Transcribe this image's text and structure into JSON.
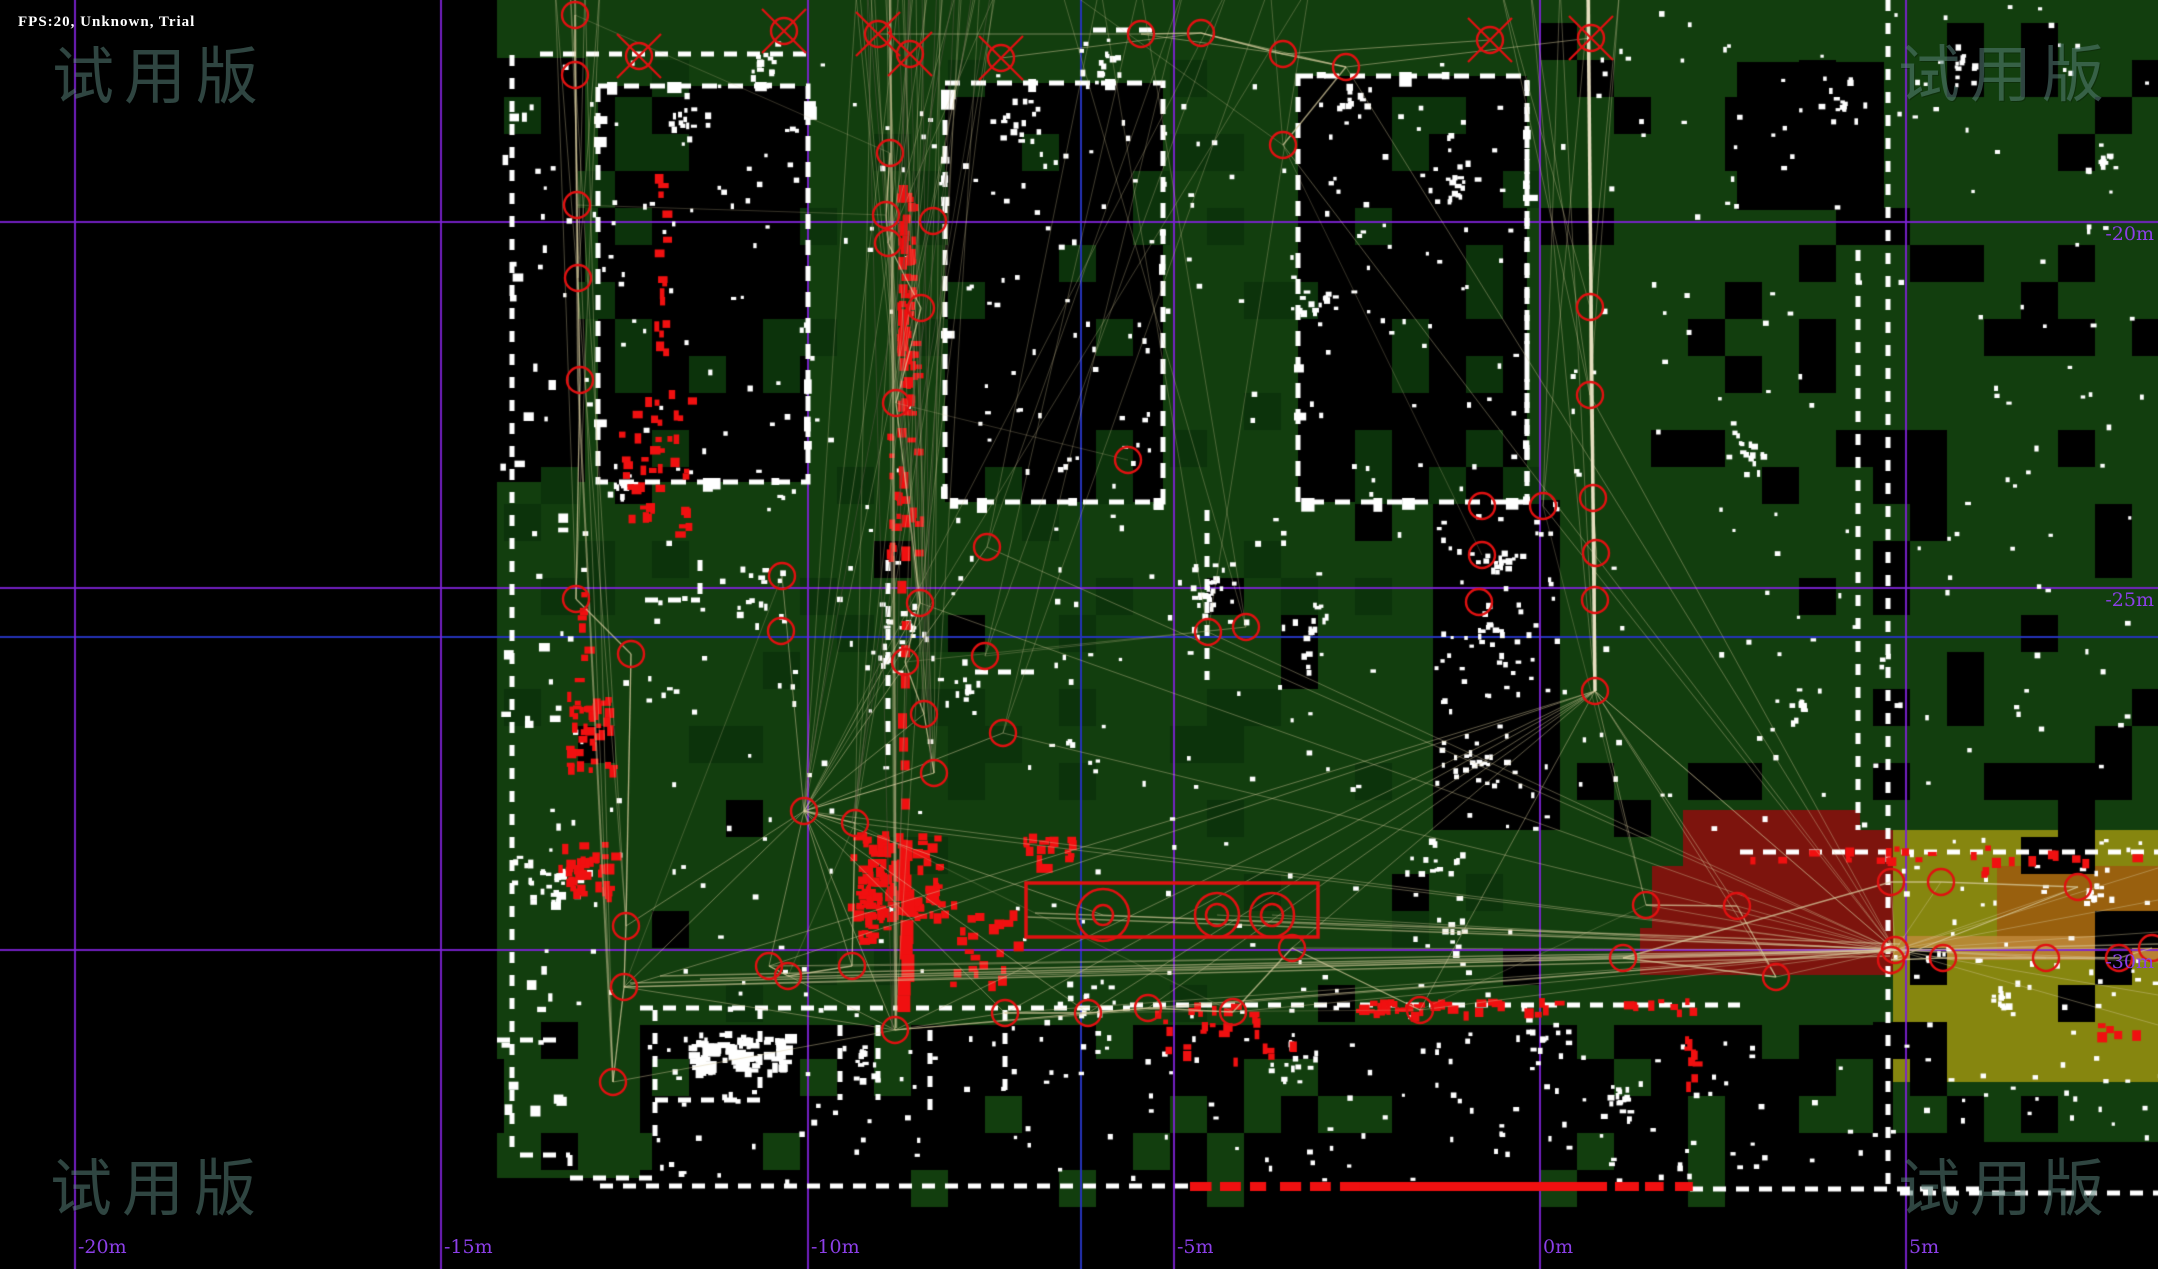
{
  "hud": {
    "status_text": "FPS:20, Unknown, Trial"
  },
  "watermark": {
    "text": "试用版",
    "positions": [
      {
        "x": 52,
        "y": 26
      },
      {
        "x": 1898,
        "y": 24
      },
      {
        "x": 50,
        "y": 1138
      },
      {
        "x": 1898,
        "y": 1138
      }
    ]
  },
  "grid": {
    "purple_color": "#7D22D4",
    "blue_color": "#2433B8",
    "label_color": "#8C3FE8",
    "purple_x": [
      74,
      440,
      807,
      1173,
      1539,
      1905
    ],
    "purple_y": [
      221,
      587,
      949
    ],
    "blue_x": [
      1080
    ],
    "blue_y": [
      636
    ],
    "x_labels": [
      {
        "text": "-20m",
        "x": 74
      },
      {
        "text": "-15m",
        "x": 440
      },
      {
        "text": "-10m",
        "x": 807
      },
      {
        "text": "-5m",
        "x": 1173
      },
      {
        "text": "0m",
        "x": 1539
      },
      {
        "text": "5m",
        "x": 1905
      }
    ],
    "y_labels": [
      {
        "text": "-20m",
        "y": 221
      },
      {
        "text": "-25m",
        "y": 587
      },
      {
        "text": "-30m",
        "y": 949
      }
    ]
  },
  "map": {
    "seed": 20,
    "colors": {
      "free": "#123E0E",
      "free_dark": "#0C330B",
      "free_light": "#1A5412",
      "unknown": "#000000",
      "wall": "#FFFFFF",
      "scan": "#F01010",
      "node": "#E01111",
      "edge": "218,205,160",
      "edge_dark": "95,92,72",
      "maroon": "#7D140D",
      "olive": "#86860F",
      "brown": "#99600E",
      "band": "#C08A3C"
    },
    "green_rects": [
      [
        497,
        0,
        1396,
        1025
      ],
      [
        497,
        1025,
        160,
        153
      ],
      [
        1893,
        0,
        265,
        830
      ],
      [
        1893,
        1082,
        265,
        60
      ]
    ],
    "black_rects": [
      [
        497,
        58,
        88,
        424
      ],
      [
        640,
        1025,
        1253,
        157
      ],
      [
        1433,
        500,
        127,
        330
      ],
      [
        1737,
        62,
        147,
        148
      ]
    ],
    "rooms": [
      [
        598,
        86,
        210,
        396
      ],
      [
        945,
        83,
        218,
        419
      ],
      [
        1298,
        76,
        229,
        426
      ]
    ],
    "maroon_poly": [
      [
        1683,
        810
      ],
      [
        1860,
        810
      ],
      [
        1860,
        830
      ],
      [
        1893,
        830
      ],
      [
        1893,
        975
      ],
      [
        1640,
        975
      ],
      [
        1640,
        928
      ],
      [
        1652,
        928
      ],
      [
        1652,
        866
      ],
      [
        1683,
        866
      ]
    ],
    "olive_rect": [
      1893,
      830,
      265,
      252
    ],
    "brown_rect": [
      1997,
      866,
      161,
      92
    ],
    "band_rect": [
      1893,
      936,
      265,
      24
    ],
    "checker_zones": [
      {
        "x": 1893,
        "x2": 2158,
        "y": 0,
        "y2": 830,
        "p": 0.22,
        "c": "unknown"
      },
      {
        "x": 1560,
        "x2": 1888,
        "y": 0,
        "y2": 830,
        "p": 0.11,
        "c": "unknown"
      },
      {
        "x": 520,
        "x2": 1530,
        "y": 490,
        "y2": 1020,
        "p": 0.035,
        "c": "unknown"
      },
      {
        "x": 520,
        "x2": 1530,
        "y": 490,
        "y2": 1020,
        "p": 0.1,
        "c": "free_dark"
      },
      {
        "x": 520,
        "x2": 1530,
        "y": 60,
        "y2": 490,
        "p": 0.05,
        "c": "free_dark"
      },
      {
        "x": 640,
        "x2": 1893,
        "y": 1025,
        "y2": 1180,
        "p": 0.13,
        "c": "free"
      },
      {
        "x": 1893,
        "x2": 2158,
        "y": 830,
        "y2": 1082,
        "p": 0.1,
        "c": "unknown"
      },
      {
        "x": 1893,
        "x2": 2158,
        "y": 1082,
        "y2": 1142,
        "p": 0.25,
        "c": "unknown"
      },
      {
        "x": 497,
        "x2": 657,
        "y": 1025,
        "y2": 1178,
        "p": 0.15,
        "c": "unknown"
      },
      {
        "x": 598,
        "x2": 1527,
        "y": 86,
        "y2": 500,
        "p": 0.08,
        "c": "free_dark"
      }
    ],
    "walls": {
      "h_dashed": [
        [
          540,
          810,
          54
        ],
        [
          1093,
          1160,
          30
        ],
        [
          640,
          1130,
          1008
        ],
        [
          655,
          760,
          1100
        ],
        [
          1130,
          1740,
          1005
        ],
        [
          1740,
          2158,
          852
        ],
        [
          600,
          1190,
          1186
        ],
        [
          1690,
          1988,
          1189
        ],
        [
          1900,
          2158,
          1193
        ],
        [
          645,
          700,
          600
        ],
        [
          975,
          1035,
          672
        ],
        [
          520,
          570,
          1155
        ],
        [
          570,
          660,
          1178
        ],
        [
          497,
          560,
          1040
        ]
      ],
      "v_dashed": [
        [
          512,
          55,
          1150
        ],
        [
          655,
          1010,
          1140
        ],
        [
          760,
          1008,
          1100
        ],
        [
          930,
          1030,
          1120
        ],
        [
          1005,
          1010,
          1100
        ],
        [
          700,
          560,
          600
        ],
        [
          888,
          560,
          760
        ],
        [
          1207,
          510,
          680
        ],
        [
          1527,
          80,
          500
        ],
        [
          1888,
          0,
          1190
        ],
        [
          1858,
          250,
          830
        ],
        [
          570,
          1155,
          1178
        ],
        [
          840,
          1025,
          1100
        ],
        [
          878,
          1025,
          1100
        ]
      ],
      "red_wall_solid": [
        1350,
        1182,
        235,
        9
      ],
      "red_wall_dash_ranges": [
        [
          1190,
          1350
        ],
        [
          1585,
          1690
        ]
      ],
      "red_wall_y": 1182
    },
    "red_clusters": [
      [
        897,
        185,
        16,
        235,
        0.9
      ],
      [
        885,
        430,
        40,
        130,
        0.25
      ],
      [
        846,
        830,
        96,
        85,
        0.75
      ],
      [
        852,
        874,
        32,
        66,
        0.6
      ],
      [
        1022,
        832,
        50,
        33,
        0.6
      ],
      [
        566,
        690,
        44,
        80,
        0.6
      ],
      [
        558,
        840,
        54,
        60,
        0.65
      ],
      [
        574,
        590,
        12,
        100,
        0.3
      ],
      [
        618,
        388,
        70,
        144,
        0.22
      ],
      [
        652,
        170,
        12,
        190,
        0.35
      ],
      [
        950,
        900,
        70,
        85,
        0.2
      ],
      [
        1352,
        998,
        210,
        14,
        0.7
      ],
      [
        1150,
        1002,
        110,
        30,
        0.3
      ],
      [
        1620,
        998,
        80,
        12,
        0.5
      ],
      [
        1682,
        1035,
        12,
        48,
        0.8
      ],
      [
        2085,
        1015,
        50,
        28,
        0.18
      ],
      [
        1977,
        862,
        20,
        10,
        0.5
      ],
      [
        1160,
        1040,
        140,
        20,
        0.15
      ],
      [
        1740,
        845,
        420,
        14,
        0.22
      ]
    ],
    "red_strip": {
      "x": 897,
      "y1": 185,
      "y2": 1010
    },
    "nodes": {
      "left_chain": [
        [
          575,
          15
        ],
        [
          575,
          75
        ],
        [
          577,
          205
        ],
        [
          578,
          278
        ],
        [
          580,
          380
        ],
        [
          576,
          599
        ],
        [
          631,
          654
        ],
        [
          626,
          926
        ],
        [
          624,
          987
        ],
        [
          613,
          1082
        ]
      ],
      "center_chain": [
        [
          890,
          153
        ],
        [
          886,
          215
        ],
        [
          888,
          243
        ],
        [
          921,
          308
        ],
        [
          896,
          403
        ],
        [
          920,
          603
        ],
        [
          905,
          662
        ],
        [
          924,
          714
        ],
        [
          934,
          773
        ],
        [
          804,
          811
        ],
        [
          855,
          823
        ],
        [
          852,
          966
        ],
        [
          788,
          976
        ],
        [
          769,
          966
        ]
      ],
      "right_chain": [
        [
          1590,
          307
        ],
        [
          1590,
          395
        ],
        [
          1593,
          498
        ],
        [
          1596,
          553
        ],
        [
          1595,
          600
        ],
        [
          1595,
          691
        ]
      ],
      "top_row": [
        [
          1141,
          34
        ],
        [
          1201,
          33
        ],
        [
          1283,
          54
        ],
        [
          1346,
          67
        ],
        [
          1283,
          145
        ]
      ],
      "bottom_row": [
        [
          1005,
          1013
        ],
        [
          1088,
          1013
        ],
        [
          1148,
          1008
        ],
        [
          1233,
          1012
        ],
        [
          1292,
          948
        ],
        [
          1420,
          1010
        ]
      ],
      "right_cluster": [
        [
          1646,
          905
        ],
        [
          1737,
          906
        ],
        [
          1776,
          977
        ],
        [
          1623,
          958
        ],
        [
          1891,
          882
        ],
        [
          1941,
          882
        ],
        [
          2078,
          887
        ],
        [
          1891,
          960
        ],
        [
          1943,
          958
        ],
        [
          2046,
          958
        ],
        [
          2119,
          958
        ],
        [
          2152,
          948
        ]
      ],
      "singles": [
        [
          933,
          221
        ],
        [
          987,
          547
        ],
        [
          985,
          656
        ],
        [
          1003,
          733
        ],
        [
          782,
          576
        ],
        [
          781,
          631
        ],
        [
          1482,
          506
        ],
        [
          1482,
          555
        ],
        [
          1479,
          602
        ],
        [
          1543,
          506
        ],
        [
          1208,
          632
        ],
        [
          1246,
          627
        ],
        [
          895,
          1030
        ],
        [
          1128,
          460
        ]
      ],
      "x_marks": [
        [
          639,
          56
        ],
        [
          784,
          31
        ],
        [
          878,
          34
        ],
        [
          910,
          54
        ],
        [
          1001,
          58
        ],
        [
          1490,
          40
        ],
        [
          1591,
          38
        ]
      ],
      "double_circles": [
        [
          1103,
          915,
          26,
          10
        ],
        [
          1217,
          915,
          22,
          11
        ],
        [
          1272,
          915,
          22,
          11
        ]
      ],
      "hub": [
        1895,
        950
      ]
    },
    "rect_marker": [
      1026,
      883,
      292,
      54
    ],
    "bundles": {
      "top_anchors_a": [
        [
          855,
          -15
        ],
        [
          870,
          -15
        ],
        [
          885,
          -15
        ],
        [
          900,
          -15
        ],
        [
          912,
          -15
        ],
        [
          925,
          -15
        ],
        [
          940,
          -15
        ],
        [
          958,
          -15
        ],
        [
          976,
          -15
        ],
        [
          995,
          -15
        ]
      ],
      "targets_a": [
        [
          896,
          403
        ],
        [
          920,
          603
        ],
        [
          924,
          714
        ],
        [
          804,
          811
        ],
        [
          855,
          823
        ],
        [
          895,
          1030
        ],
        [
          934,
          773
        ],
        [
          888,
          243
        ]
      ],
      "top_anchors_b": [
        [
          1060,
          -15
        ],
        [
          1100,
          -15
        ],
        [
          1140,
          -15
        ],
        [
          1185,
          -15
        ],
        [
          1230,
          -15
        ],
        [
          1270,
          -15
        ],
        [
          1310,
          -15
        ]
      ],
      "targets_b": [
        [
          1283,
          145
        ],
        [
          1208,
          632
        ],
        [
          1246,
          627
        ],
        [
          987,
          547
        ],
        [
          985,
          656
        ],
        [
          1003,
          733
        ],
        [
          804,
          811
        ]
      ],
      "top_anchors_c": [
        [
          1500,
          -15
        ],
        [
          1530,
          -15
        ],
        [
          1560,
          -15
        ],
        [
          1590,
          -15
        ],
        [
          1620,
          -15
        ]
      ],
      "targets_c": [
        [
          1590,
          307
        ],
        [
          1590,
          395
        ],
        [
          1595,
          691
        ],
        [
          1543,
          506
        ]
      ],
      "left_anchors": [
        [
          555,
          -15
        ],
        [
          570,
          -15
        ],
        [
          585,
          -15
        ],
        [
          600,
          -15
        ]
      ],
      "left_targets": [
        [
          576,
          599
        ],
        [
          626,
          926
        ],
        [
          613,
          1082
        ],
        [
          578,
          278
        ]
      ],
      "band_lines": [
        [
          630,
          983,
          1893,
          952
        ],
        [
          660,
          976,
          1895,
          950
        ],
        [
          624,
          987,
          1890,
          956
        ],
        [
          1027,
          917,
          1893,
          949
        ],
        [
          1035,
          913,
          1900,
          944
        ],
        [
          700,
          979,
          2158,
          944
        ]
      ],
      "hub_exits": [
        [
          2158,
          868
        ],
        [
          2158,
          900
        ],
        [
          2158,
          932
        ],
        [
          2158,
          962
        ],
        [
          2158,
          995
        ],
        [
          2158,
          1025
        ]
      ]
    },
    "dot_clusters": [
      [
        560,
        872,
        28
      ],
      [
        745,
        600,
        40
      ],
      [
        905,
        625,
        35
      ],
      [
        965,
        685,
        30
      ],
      [
        1210,
        600,
        40
      ],
      [
        1310,
        625,
        30
      ],
      [
        1490,
        625,
        35
      ],
      [
        705,
        1048,
        55
      ],
      [
        860,
        1055,
        30
      ],
      [
        1085,
        1003,
        30
      ],
      [
        1500,
        565,
        30
      ],
      [
        1453,
        935,
        40
      ],
      [
        1540,
        1040,
        30
      ],
      [
        680,
        120,
        30
      ],
      [
        1020,
        120,
        25
      ],
      [
        760,
        60,
        25
      ],
      [
        1100,
        60,
        25
      ],
      [
        1350,
        100,
        25
      ],
      [
        1840,
        100,
        30
      ],
      [
        1960,
        60,
        25
      ],
      [
        2100,
        160,
        20
      ],
      [
        1750,
        450,
        25
      ],
      [
        1800,
        700,
        25
      ],
      [
        1480,
        760,
        30
      ],
      [
        1430,
        870,
        35
      ],
      [
        1290,
        1060,
        30
      ],
      [
        1620,
        1100,
        25
      ],
      [
        2000,
        1000,
        30
      ],
      [
        2090,
        890,
        25
      ],
      [
        1450,
        180,
        25
      ],
      [
        1310,
        300,
        25
      ],
      [
        888,
        660,
        30
      ],
      [
        1207,
        580,
        25
      ],
      [
        620,
        480,
        25
      ],
      [
        530,
        880,
        30
      ]
    ]
  }
}
